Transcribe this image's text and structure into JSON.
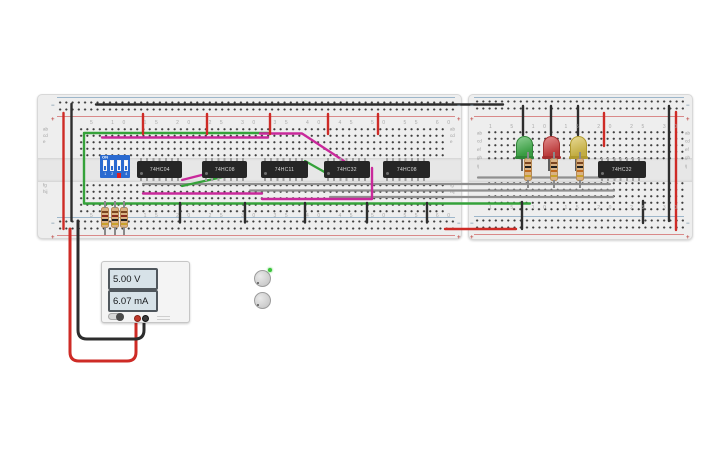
{
  "scene": {
    "background": "#ffffff"
  },
  "colors": {
    "wire_red": "#ce2b26",
    "wire_black": "#2d2d2d",
    "wire_green": "#35a23a",
    "wire_magenta": "#c9299b",
    "wire_gray": "#8f8f8f",
    "wire_trace_white": "#e6e6e6",
    "led_green": "#3fae49",
    "led_red": "#cf4040",
    "led_yellow": "#d8c04a",
    "dip_body_blue": "#2a6ad0",
    "dip_active_red": "#e01f1f",
    "ic_body": "#262626",
    "board_body": "#eeeeee"
  },
  "power_supply": {
    "voltage": "5.00 V",
    "current": "6.07 mA"
  },
  "dip_switch": {
    "on_label": "ON",
    "positions": [
      "1",
      "2",
      "3",
      "4"
    ]
  },
  "breadboard_main": {
    "column_numbers": "5 10 15 20 25 30 35 40 45 50 55 60",
    "row_letters_top": "abcde",
    "row_letters_bottom": "fghij",
    "rail_plus": "+",
    "rail_minus": "−",
    "ics": [
      {
        "label": "74HC04"
      },
      {
        "label": "74HC08"
      },
      {
        "label": "74HC11"
      },
      {
        "label": "74HC32"
      },
      {
        "label": "74HC08"
      }
    ]
  },
  "breadboard_secondary": {
    "column_numbers": "1 5 10 15 20 25 30",
    "row_letters": "abcdefghij",
    "rail_plus": "+",
    "rail_minus": "−",
    "ic": {
      "label": "74HC32"
    },
    "leds": [
      {
        "name": "green-led",
        "color": "#3fae49"
      },
      {
        "name": "red-led",
        "color": "#cf4040"
      },
      {
        "name": "yellow-led",
        "color": "#d8c04a"
      }
    ]
  }
}
